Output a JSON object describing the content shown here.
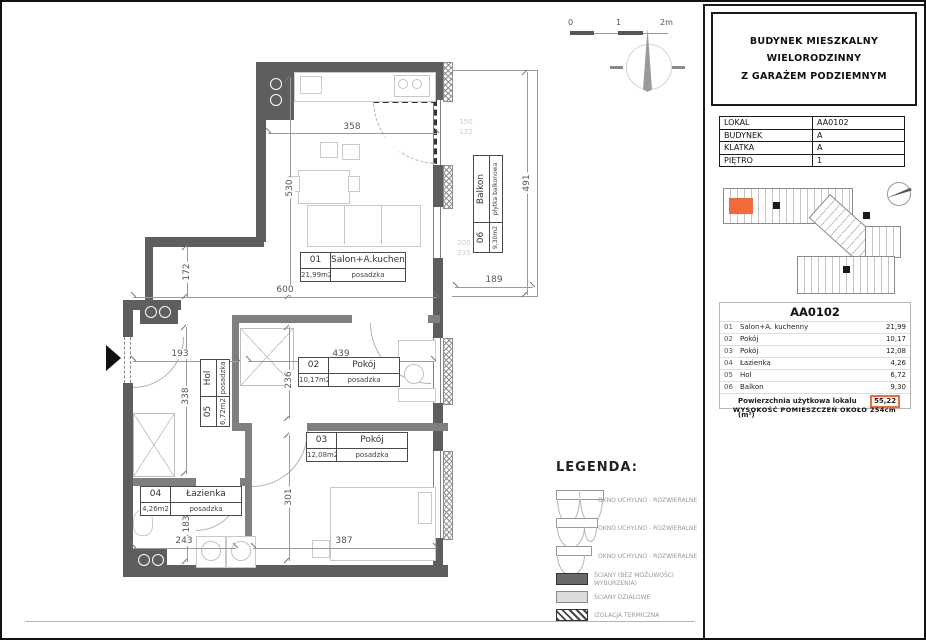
{
  "colors": {
    "accent": "#f2693a",
    "wall": "#5e5e5e"
  },
  "scalebar": {
    "zero": "0",
    "one": "1",
    "two": "2m"
  },
  "plan": {
    "rooms": [
      {
        "num": "01",
        "name": "Salon+A.kuchenny",
        "area": "21,99m2",
        "floor": "posadzka"
      },
      {
        "num": "02",
        "name": "Pokój",
        "area": "10,17m2",
        "floor": "posadzka"
      },
      {
        "num": "03",
        "name": "Pokój",
        "area": "12,08m2",
        "floor": "posadzka"
      },
      {
        "num": "04",
        "name": "Łazienka",
        "area": "4,26m2",
        "floor": "posadzka"
      },
      {
        "num": "05",
        "name": "Hol",
        "area": "6,72m2",
        "floor": "posadzka"
      },
      {
        "num": "06",
        "name": "Balkon",
        "area": "9,30m2",
        "floor": "płytka balkonowa"
      }
    ],
    "dims": {
      "d358": "358",
      "d530": "530",
      "d600": "600",
      "d172": "172",
      "d193": "193",
      "d439": "439",
      "d236": "236",
      "d338": "338",
      "d301": "301",
      "d183": "183",
      "d243": "243",
      "d387": "387",
      "d189": "189",
      "d491": "491",
      "f150": "150",
      "f122": "122",
      "f200": "200",
      "f235": "235"
    }
  },
  "legend": {
    "title": "LEGENDA:",
    "windows": [
      {
        "label": "OKNO UCHYLNO - ROZWIERALNE"
      },
      {
        "label": "OKNO UCHYLNO - ROZWIERALNE"
      },
      {
        "label": "OKNO UCHYLNO - ROZWIERALNE"
      }
    ],
    "walls": [
      {
        "label": "ŚCIANY (BEZ MOŻLIWOŚCI WYBURZENIA)"
      },
      {
        "label": "ŚCIANY DZIAŁOWE"
      },
      {
        "label": "IZOLACJA TERMICZNA"
      }
    ]
  },
  "panel": {
    "title_line1": "BUDYNEK MIESZKALNY WIELORODZINNY",
    "title_line2": "Z GARAŻEM PODZIEMNYM",
    "info": [
      {
        "label": "LOKAL",
        "value": "AA0102"
      },
      {
        "label": "BUDYNEK",
        "value": "A"
      },
      {
        "label": "KLATKA",
        "value": "A"
      },
      {
        "label": "PIĘTRO",
        "value": "1"
      }
    ],
    "schedule": {
      "header": "AA0102",
      "rows": [
        {
          "no": "01",
          "name": "Salon+A. kuchenny",
          "value": "21,99"
        },
        {
          "no": "02",
          "name": "Pokój",
          "value": "10,17"
        },
        {
          "no": "03",
          "name": "Pokój",
          "value": "12,08"
        },
        {
          "no": "04",
          "name": "Łazienka",
          "value": "4,26"
        },
        {
          "no": "05",
          "name": "Hol",
          "value": "6,72"
        },
        {
          "no": "06",
          "name": "Balkon",
          "value": "9,30"
        }
      ],
      "total_label": "Powierzchnia użytkowa lokalu (m²)",
      "total_value": "55,22"
    },
    "note": "WYSOKOŚĆ POMIESZCZEŃ OKOŁO 254cm"
  }
}
